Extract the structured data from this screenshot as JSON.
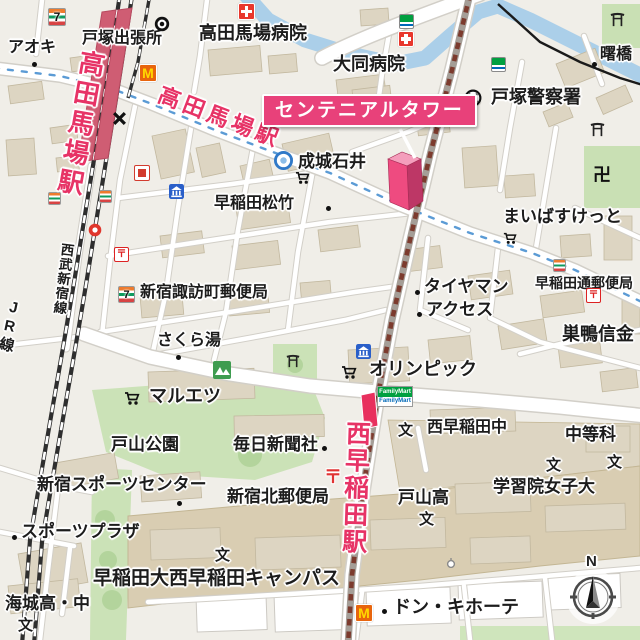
{
  "map": {
    "callout": {
      "label": "センテニアルタワー",
      "color": "#e8417a"
    },
    "stations": {
      "takadanobaba_platform": "高田馬場駅",
      "takadanobaba_road": "高田馬場駅",
      "nishiwaseda": "西早稲田駅"
    },
    "railways": {
      "jr": "JR線",
      "seibu": "西武新宿線"
    },
    "compass": {
      "north": "N"
    },
    "glyphs": {
      "seven": "7",
      "mcdonalds": "M",
      "post": "〒",
      "manji": "卍",
      "school": "文",
      "familymart": "FamilyMart",
      "bridge_dot": "・"
    },
    "colors": {
      "accent_pink": "#e8417a",
      "label_red": "#e73366",
      "bus_dash_blue": "#5b9bd5",
      "subway_dash_brown": "#7c3b2e",
      "water": "#abcfe9",
      "park_green": "#cbe2b7",
      "building_tan": "#ddd5c2",
      "campus_tan": "#d9cdb2"
    },
    "pois": [
      {
        "label": "アオキ",
        "x": 8,
        "y": 40,
        "s": 16
      },
      {
        "label": "戸塚出張所",
        "x": 82,
        "y": 31,
        "s": 16
      },
      {
        "label": "高田馬場病院",
        "x": 199,
        "y": 24,
        "s": 18
      },
      {
        "label": "大同病院",
        "x": 333,
        "y": 55,
        "s": 18
      },
      {
        "label": "曙橋",
        "x": 600,
        "y": 47,
        "s": 16
      },
      {
        "label": "戸塚警察署",
        "x": 491,
        "y": 88,
        "s": 18
      },
      {
        "label": "成城石井",
        "x": 298,
        "y": 153,
        "s": 17
      },
      {
        "label": "早稲田松竹",
        "x": 214,
        "y": 196,
        "s": 16
      },
      {
        "label": "まいばすけっと",
        "x": 503,
        "y": 208,
        "s": 17
      },
      {
        "label": "新宿諏訪町郵便局",
        "x": 140,
        "y": 285,
        "s": 16
      },
      {
        "label": "早稲田通郵便局",
        "x": 535,
        "y": 276,
        "s": 14
      },
      {
        "label": "タイヤマン",
        "x": 424,
        "y": 278,
        "s": 17
      },
      {
        "label": "アクセス",
        "x": 426,
        "y": 301,
        "s": 17
      },
      {
        "label": "巣鴨信金",
        "x": 562,
        "y": 325,
        "s": 18
      },
      {
        "label": "さくら湯",
        "x": 157,
        "y": 333,
        "s": 16
      },
      {
        "label": "オリンピック",
        "x": 369,
        "y": 360,
        "s": 18
      },
      {
        "label": "マルエツ",
        "x": 149,
        "y": 387,
        "s": 18
      },
      {
        "label": "戸山公園",
        "x": 111,
        "y": 436,
        "s": 17
      },
      {
        "label": "毎日新聞社",
        "x": 233,
        "y": 436,
        "s": 17
      },
      {
        "label": "西早稲田中",
        "x": 427,
        "y": 420,
        "s": 16
      },
      {
        "label": "中等科",
        "x": 565,
        "y": 426,
        "s": 17
      },
      {
        "label": "新宿スポーツセンター",
        "x": 37,
        "y": 476,
        "s": 17
      },
      {
        "label": "新宿北郵便局",
        "x": 227,
        "y": 488,
        "s": 17
      },
      {
        "label": "スポーツプラザ",
        "x": 21,
        "y": 523,
        "s": 17
      },
      {
        "label": "学習院女子大",
        "x": 493,
        "y": 478,
        "s": 17
      },
      {
        "label": "戸山高",
        "x": 398,
        "y": 489,
        "s": 17
      },
      {
        "label": "早稲田大西早稲田キャンパス",
        "x": 93,
        "y": 569,
        "s": 19
      },
      {
        "label": "海城高・中",
        "x": 5,
        "y": 595,
        "s": 17
      },
      {
        "label": "ドン・キホーテ",
        "x": 393,
        "y": 598,
        "s": 18
      }
    ],
    "school_marks": [
      {
        "x": 398,
        "y": 423
      },
      {
        "x": 546,
        "y": 458
      },
      {
        "x": 607,
        "y": 455
      },
      {
        "x": 419,
        "y": 512
      },
      {
        "x": 18,
        "y": 618
      },
      {
        "x": 215,
        "y": 548
      }
    ],
    "dots": [
      {
        "x": 32,
        "y": 62
      },
      {
        "x": 176,
        "y": 355
      },
      {
        "x": 326,
        "y": 206
      },
      {
        "x": 415,
        "y": 290
      },
      {
        "x": 417,
        "y": 312
      },
      {
        "x": 322,
        "y": 446
      },
      {
        "x": 177,
        "y": 501
      },
      {
        "x": 12,
        "y": 535
      },
      {
        "x": 382,
        "y": 609
      },
      {
        "x": 592,
        "y": 62
      }
    ],
    "icons": [
      {
        "name": "seven-eleven-icon",
        "x": 48,
        "y": 8,
        "s": 16
      },
      {
        "name": "seven-eleven-icon",
        "x": 118,
        "y": 286,
        "s": 15
      },
      {
        "name": "seven-eleven-icon",
        "x": 48,
        "y": 192,
        "s": 11
      },
      {
        "name": "seven-eleven-icon",
        "x": 99,
        "y": 190,
        "s": 11
      },
      {
        "name": "seven-eleven-icon",
        "x": 553,
        "y": 259,
        "s": 11
      },
      {
        "name": "familymart-icon",
        "x": 399,
        "y": 14,
        "s": 13
      },
      {
        "name": "familymart-icon",
        "x": 491,
        "y": 57,
        "s": 13
      },
      {
        "name": "familymart-sign-icon",
        "x": 377,
        "y": 386,
        "s": 0
      },
      {
        "name": "mcdonalds-icon",
        "x": 139,
        "y": 64,
        "s": 16
      },
      {
        "name": "mcdonalds-icon",
        "x": 355,
        "y": 604,
        "s": 16
      },
      {
        "name": "hospital-icon",
        "x": 238,
        "y": 3,
        "s": 15
      },
      {
        "name": "hospital-icon",
        "x": 398,
        "y": 31,
        "s": 14
      },
      {
        "name": "police-icon",
        "x": 464,
        "y": 89,
        "s": 18
      },
      {
        "name": "ward-office-icon",
        "x": 154,
        "y": 16,
        "s": 16
      },
      {
        "name": "post-office-icon",
        "x": 114,
        "y": 247,
        "s": 13
      },
      {
        "name": "post-office-icon",
        "x": 586,
        "y": 288,
        "s": 13
      },
      {
        "name": "post-office-mark-icon",
        "x": 324,
        "y": 468,
        "s": 18
      },
      {
        "name": "bank-icon",
        "x": 169,
        "y": 184,
        "s": 15
      },
      {
        "name": "bank-icon",
        "x": 356,
        "y": 344,
        "s": 15
      },
      {
        "name": "cart-icon",
        "x": 295,
        "y": 170,
        "s": 15
      },
      {
        "name": "cart-icon",
        "x": 341,
        "y": 364,
        "s": 16
      },
      {
        "name": "cart-icon",
        "x": 124,
        "y": 390,
        "s": 16
      },
      {
        "name": "cart-icon",
        "x": 503,
        "y": 231,
        "s": 14
      },
      {
        "name": "torii-icon",
        "x": 610,
        "y": 12,
        "s": 15
      },
      {
        "name": "torii-icon",
        "x": 590,
        "y": 122,
        "s": 15
      },
      {
        "name": "torii-icon",
        "x": 286,
        "y": 354,
        "s": 14
      },
      {
        "name": "manji-icon",
        "x": 593,
        "y": 166,
        "s": 18
      },
      {
        "name": "park-icon",
        "x": 213,
        "y": 361,
        "s": 18
      },
      {
        "name": "seijo-ishii-icon",
        "x": 274,
        "y": 151,
        "s": 19
      },
      {
        "name": "x-mark-icon",
        "x": 112,
        "y": 111,
        "s": 15
      },
      {
        "name": "store-icon",
        "x": 134,
        "y": 165,
        "s": 14
      },
      {
        "name": "restaurant-icon",
        "x": 88,
        "y": 223,
        "s": 14
      },
      {
        "name": "monument-icon",
        "x": 446,
        "y": 558,
        "s": 10
      }
    ]
  }
}
